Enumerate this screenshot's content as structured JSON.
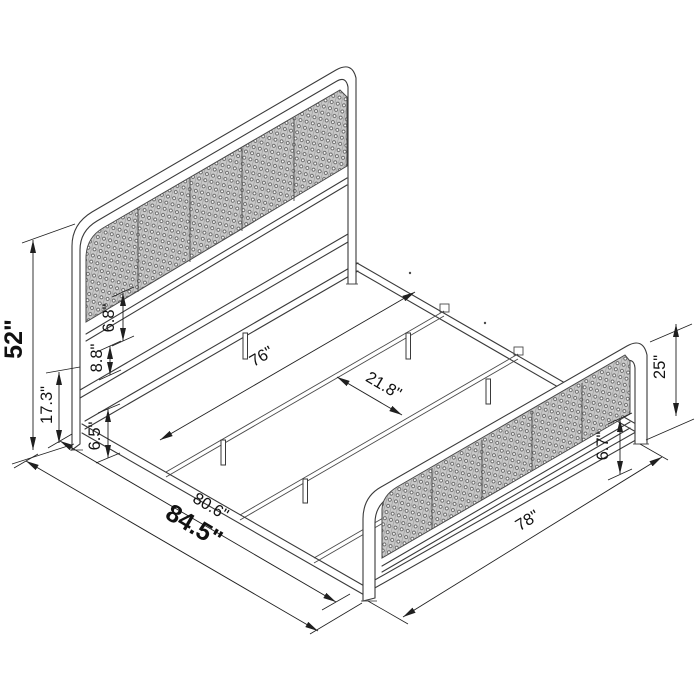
{
  "dimensions": {
    "overall_height": "52\"",
    "headboard_leg_height": "17.3\"",
    "headboard_panel_gap": "6.8\"",
    "headboard_rail_gap": "8.8\"",
    "frame_floor_clearance": "6.5\"",
    "slat_span_width": "76\"",
    "slat_spacing": "21.8\"",
    "interior_length": "80.6\"",
    "overall_length": "84.5\"",
    "overall_width": "78\"",
    "footboard_height": "25\"",
    "footboard_rail_gap": "6.7\""
  },
  "colors": {
    "background": "#ffffff",
    "structure_line": "#3a3a3a",
    "dimension_line": "#1f1f1f",
    "text": "#111111",
    "cane_fill": "#c9c9c9",
    "cane_weave": "#585858"
  }
}
